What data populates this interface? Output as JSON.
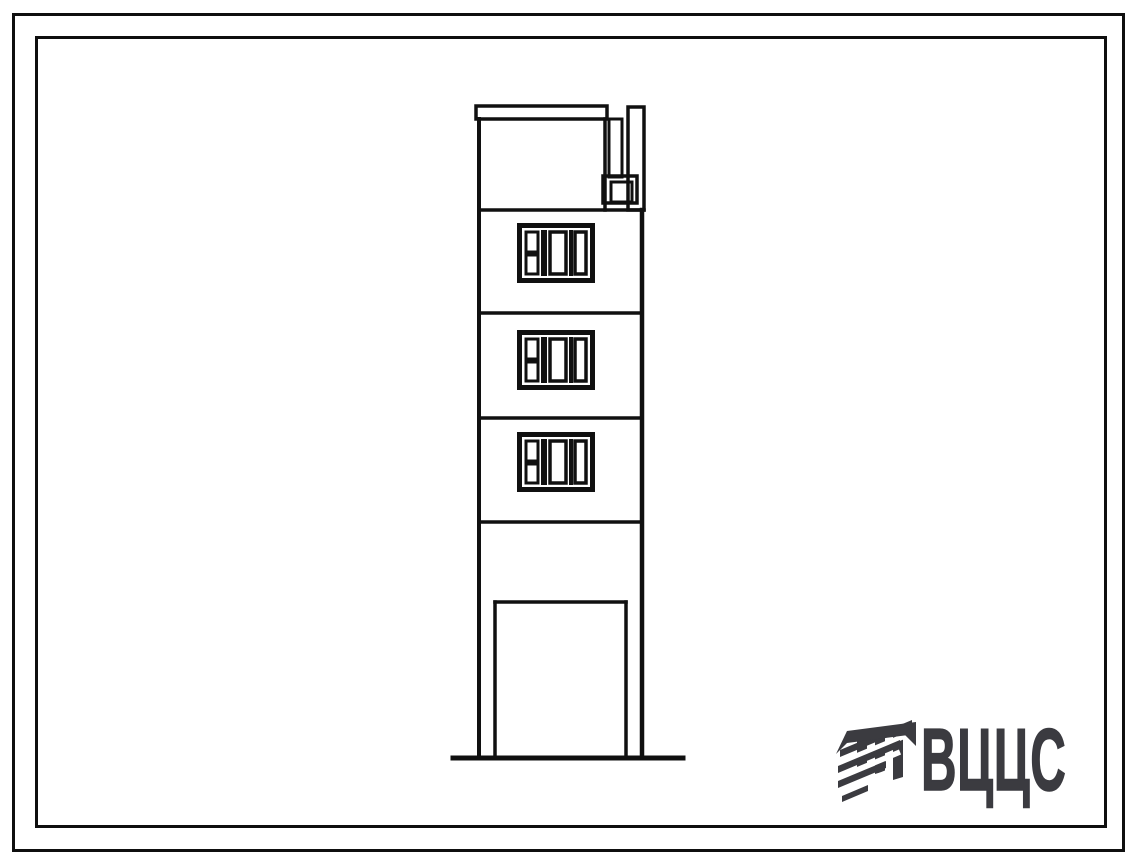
{
  "sheet": {
    "background_color": "#ffffff",
    "line_color": "#101010",
    "borders": {
      "outer": "double-frame outer rule",
      "inner": "double-frame inner rule"
    }
  },
  "logo": {
    "text": "ВЦЦС",
    "color": "#3b3b40",
    "mark": "hatched-roof-monogram"
  },
  "drawing": {
    "subject": "end-wall elevation of narrow multi-storey panel building",
    "storeys_shown": 5,
    "identical_windows_shown": 3,
    "features": [
      "top parapet slab",
      "roof ventilation stack at right",
      "three floors with composite windows",
      "blank spandrel band",
      "open ground floor on two pilotis columns",
      "ground line"
    ]
  }
}
